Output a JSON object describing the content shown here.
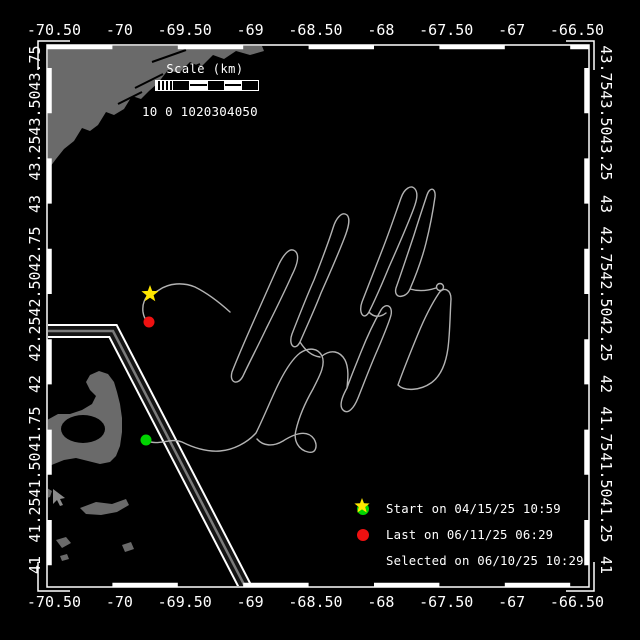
{
  "colors": {
    "background": "#000000",
    "land": "#6a6a6a",
    "track": "#b3b3b3",
    "frame": "#ffffff",
    "text": "#ffffff",
    "lane_dark": "#141414",
    "lane_center": "#7a7a7a",
    "start": "#00d400",
    "last": "#ee1111",
    "selected": "#ffe600"
  },
  "axes": {
    "lon_labels": [
      "-70.50",
      "-70",
      "-69.50",
      "-69",
      "-68.50",
      "-68",
      "-67.50",
      "-67",
      "-66.50"
    ],
    "lat_labels": [
      "43.75",
      "43.50",
      "43.25",
      "43",
      "42.75",
      "42.50",
      "42.25",
      "42",
      "41.75",
      "41.50",
      "41.25",
      "41"
    ]
  },
  "scale_bar": {
    "title": "Scale (km)",
    "tick_text": "10 0 1020304050"
  },
  "legend": {
    "items": [
      {
        "icon": "start-dot",
        "color": "#00d400",
        "label": "Start on 04/15/25 10:59"
      },
      {
        "icon": "last-dot",
        "color": "#ee1111",
        "label": "Last on 06/11/25 06:29"
      },
      {
        "icon": "selected-star",
        "color": "#ffe600",
        "label": "Selected on 06/10/25 10:29"
      }
    ],
    "star_points": "10,2 12,7.2 17.6,7.5 13.2,11 14.7,16.5 10,13.4 5.3,16.5 6.8,11 2.4,7.5 8,7.2"
  },
  "markers": {
    "start": {
      "x": 146,
      "y": 440,
      "r": 5.5
    },
    "last": {
      "x": 149,
      "y": 322,
      "r": 5.5
    },
    "selected": {
      "x": 150,
      "y": 294,
      "points": "150,285 152.2,290.9 158.6,291.2 153.6,295.2 155.3,301.3 150,297.8 144.7,301.3 146.4,295.2 141.4,291.2 147.8,290.9"
    }
  },
  "geometry": {
    "track_d": "M146,440 C158,447 170,437 182,442 C194,448 207,452 220,451 C233,450 247,443 256,433 C263,419 269,404 276,389 C283,374 291,360 300,353 C309,347 318,348 322,356 C326,365 319,377 313,389 C305,403 299,417 296,430 C293,441 299,450 308,452 C316,454 318,446 314,439 C307,429 294,434 283,441 C273,447 263,446 257,439 M322,356 C331,349 340,351 345,360 C349,368 348,378 347,388 C342,397 339,406 343,410 C348,415 354,408 358,398 C364,383 370,367 377,351 C383,337 389,323 391,315 C393,306 386,302 381,310 C374,322 367,337 361,352 C355,367 350,379 347,388 M398,385 C404,368 411,351 418,334 C425,317 433,302 439,293 C444,286 451,290 451,299 C450,315 450,332 448,348 C446,363 441,376 431,383 C421,390 405,392 398,385 M232,372 C239,354 247,336 255,318 C263,300 271,282 279,264 C284,254 290,247 295,251 C300,255 297,265 292,275 C284,293 275,311 266,329 C258,346 249,363 243,376 C238,386 229,383 232,372 M292,334 C299,316 306,298 314,280 C321,262 328,244 333,228 C336,218 342,211 347,215 C351,219 348,229 344,239 C337,257 329,275 321,293 C314,311 306,328 300,342 C295,352 288,345 292,334 M362,302 C369,284 376,266 383,248 C390,230 396,212 401,198 C404,189 411,184 415,189 C419,194 416,203 412,213 C405,231 397,249 389,267 C382,284 375,300 369,312 C364,321 358,313 362,302 M396,288 C402,271 408,253 414,235 C419,219 424,204 427,195 C430,186 436,188 435,197 C433,211 430,227 426,243 C422,259 416,275 410,289 C406,299 393,299 396,288 M410,289 C420,292 430,290 436,288 M300,342 C305,350 312,356 320,357 M369,312 C374,318 381,317 386,313 M230,312 C219,302 207,293 195,287 C183,282 169,283 159,290 C156,292 153,294 150,294 C145,297 142,304 143,312 C144,318 146,321 149,322",
    "lane_d": "M44,331 L113,331 L252,600",
    "knot": {
      "cx": 440,
      "cy": 287,
      "r": 3.5
    },
    "land_maine_points": "47,46 262,46 264,51 250,55 236,51 224,59 213,55 201,67 190,62 179,73 168,70 158,83 149,91 141,99 132,96 124,109 114,115 106,112 98,125 90,131 82,128 74,141 64,149 56,159 50,167 47,171",
    "land_cape_points": "47,420 58,414 70,414 82,410 92,404 96,396 90,390 86,382 90,375 99,371 108,374 114,382 117,392 120,404 122,418 122,432 120,446 116,456 110,462 100,464 88,461 76,458 64,460 54,464 47,467",
    "bay": {
      "cx": 83,
      "cy": 429,
      "rx": 22,
      "ry": 14
    },
    "island1_points": "80,508 96,502 112,504 126,499 129,505 117,512 101,515 86,514",
    "island2_points": "56,540 66,537 71,543 62,548",
    "island3_points": "122,545 131,542 134,549 125,552",
    "island4_points": "60,556 67,554 69,559 62,561",
    "island5_points": "47,488 52,491 50,497 47,498",
    "cursor_points": "53,489 53,504 57,500 60,506 63,505 60,499 65,498"
  }
}
